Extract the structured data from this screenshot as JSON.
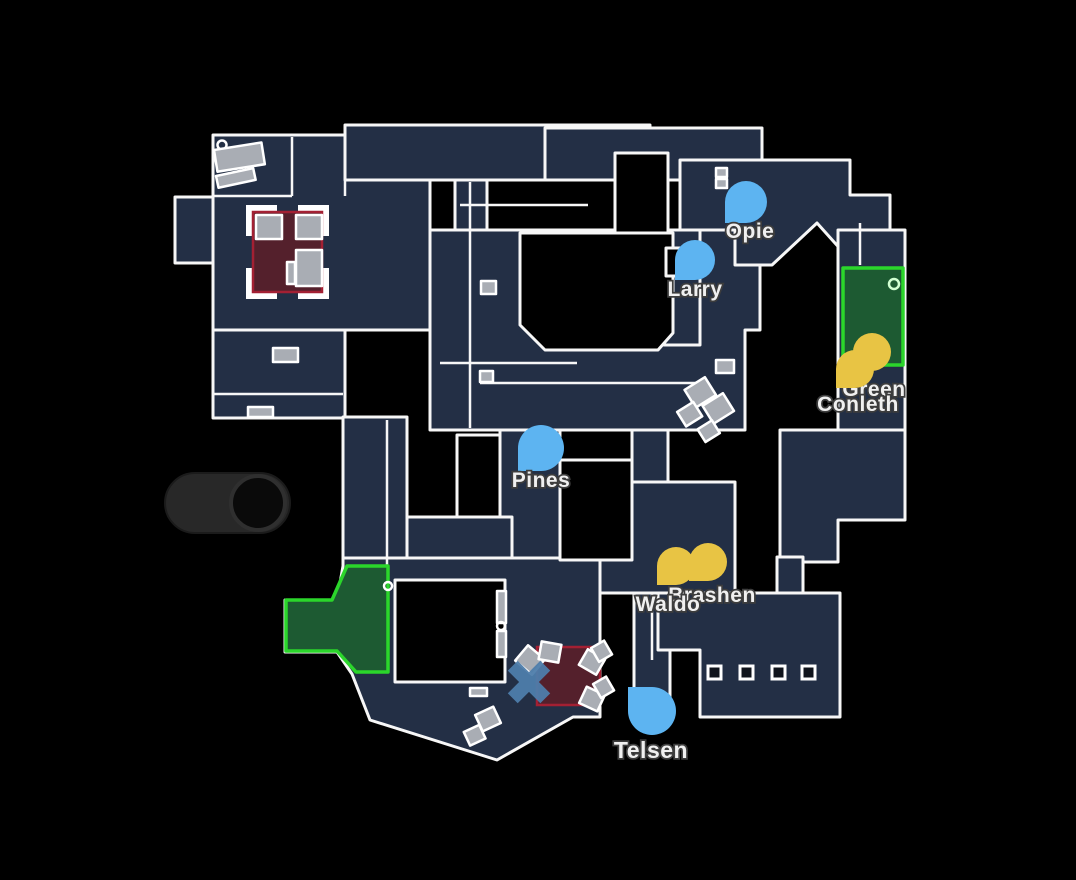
{
  "app": {
    "view": "minimap-overview"
  },
  "colors": {
    "background": "#000000",
    "floor": "#232f45",
    "wall": "#f7f7f7",
    "blue_marker": "#5db4f1",
    "yellow_marker": "#e8c444",
    "green_zone_fill": "#1d5a32",
    "green_zone_border": "#2bd62b",
    "red_zone_fill": "#54202c",
    "red_zone_border": "#a32033",
    "crate_fill": "#a9adb4",
    "x_marker": "#4e7dab",
    "toggle_body": "#282828",
    "toggle_knob": "#0a0a0a"
  },
  "players": {
    "blue": [
      {
        "name": "Opie",
        "color": "#5db4f1",
        "transform": "translate(746,202)"
      },
      {
        "name": "Larry",
        "color": "#5db4f1",
        "transform": "translate(695,260)"
      },
      {
        "name": "Pines",
        "color": "#5db4f1",
        "transform": "translate(541,448)"
      },
      {
        "name": "Telsen",
        "color": "#5db4f1",
        "transform": "translate(652,711)"
      }
    ],
    "yellow": [
      {
        "name": "Green",
        "color": "#e8c444",
        "transform": "translate(872,352)"
      },
      {
        "name": "Conleth",
        "color": "#e8c444",
        "transform": "translate(855,369)"
      },
      {
        "name": "Brashen",
        "color": "#e8c444",
        "transform": "translate(708,562)"
      },
      {
        "name": "Waldo",
        "color": "#e8c444",
        "transform": "translate(676,566)"
      }
    ]
  },
  "death_marker": {
    "transform": "translate(529,682) rotate(45)",
    "color": "#4e7dab"
  },
  "toggle": {
    "knob_position": "right"
  }
}
